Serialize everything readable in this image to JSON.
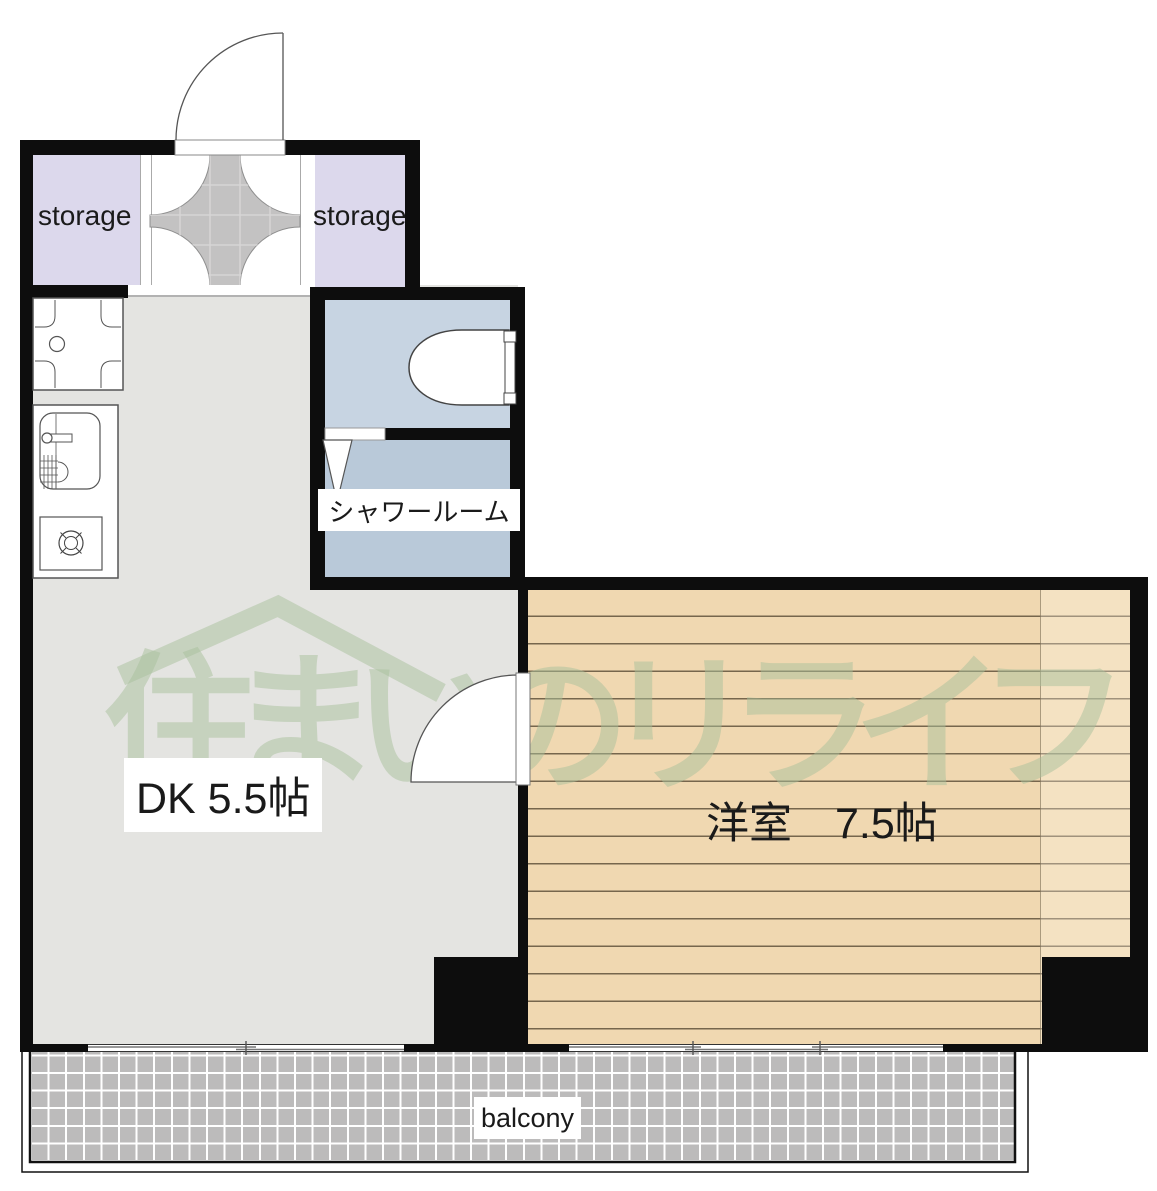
{
  "floorplan": {
    "labels": {
      "storage_left": "storage",
      "storage_right": "storage",
      "shower": "シャワールーム",
      "dk": "DK 5.5帖",
      "western": "洋室　7.5帖",
      "balcony": "balcony"
    },
    "rooms": [
      {
        "name": "storage_left",
        "label": "storage"
      },
      {
        "name": "storage_right",
        "label": "storage"
      },
      {
        "name": "toilet",
        "label": ""
      },
      {
        "name": "shower_room",
        "label": "シャワールーム"
      },
      {
        "name": "dining_kitchen",
        "label": "DK 5.5帖",
        "size_jo": "5.5"
      },
      {
        "name": "western_room",
        "label": "洋室　7.5帖",
        "size_jo": "7.5"
      },
      {
        "name": "balcony",
        "label": "balcony"
      }
    ],
    "watermark": {
      "text": "住まいのリライフ",
      "color": "rgba(168,192,155,0.5)"
    },
    "icons": {
      "entrance_door": "quarter-arc-door",
      "room_door": "quarter-arc-door",
      "shower_door": "folding-door-triangle",
      "toilet": "toilet-bowl-top-view",
      "kitchen_sink": "sink-with-faucet",
      "stove": "single-burner-stove",
      "washing_machine": "washer-pan",
      "window": "sliding-window-double-line"
    },
    "colors": {
      "wall": "#0d0d0d",
      "storage_fill": "#dcd8ec",
      "toilet_fill": "#c7d4e2",
      "shower_fill": "#b9c9d9",
      "dk_floor": "#e4e4e1",
      "wood_floor": "#f0d8b1",
      "entrance_tile": "#c3c2c2",
      "balcony_tile": "#bcbbbb"
    }
  }
}
